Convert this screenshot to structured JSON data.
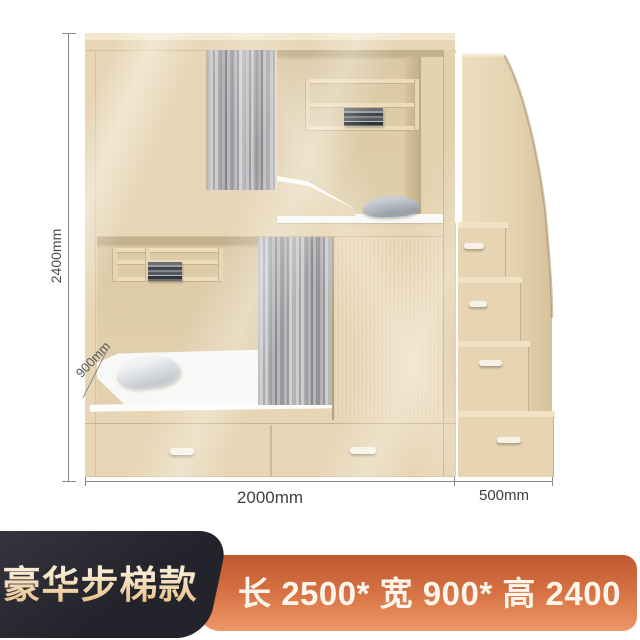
{
  "banner": {
    "badge_label": "豪华步梯款",
    "spec_label": "长 2500* 宽 900* 高 2400"
  },
  "dimensions": {
    "height": "2400mm",
    "depth": "900mm",
    "length": "2000mm",
    "stair_width": "500mm"
  },
  "colors": {
    "badge_bg": "#23232b",
    "badge_text": "#f2d7a6",
    "spec_bg_top": "#bf5930",
    "spec_bg_bottom": "#ef9767",
    "spec_text": "#fcf5ec",
    "wood": "#e7d6b5",
    "wood_interior": "#dccaa6",
    "curtain": "#a6a6ab",
    "dimension": "#8a8a8a"
  }
}
